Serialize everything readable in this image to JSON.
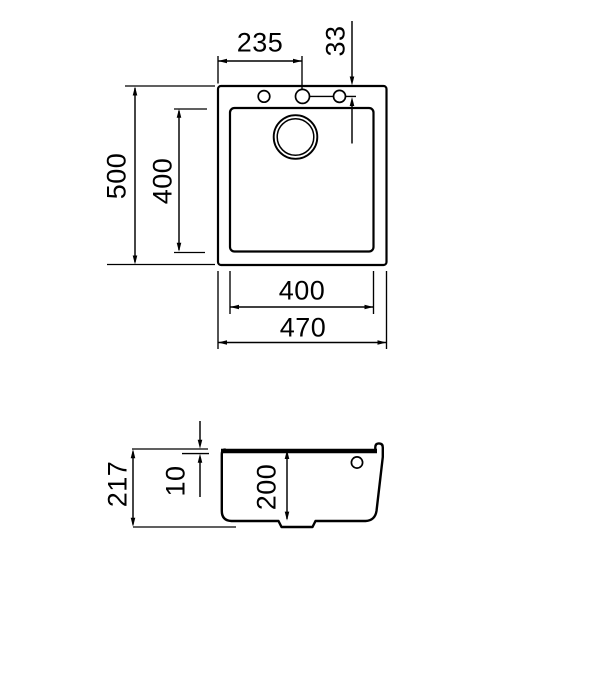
{
  "dims": {
    "top_view": {
      "tap_hole_offset_from_left": "235",
      "tap_hole_offset_from_top": "33",
      "overall_depth": "500",
      "bowl_depth": "400",
      "bowl_width": "400",
      "overall_width": "470"
    },
    "section_view": {
      "overall_height": "217",
      "rim_thickness": "10",
      "bowl_inner_depth": "200"
    }
  }
}
